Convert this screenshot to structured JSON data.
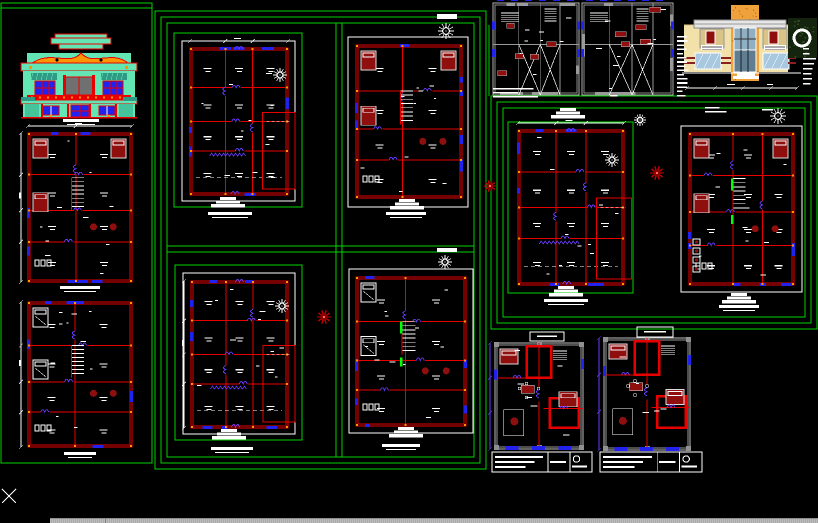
{
  "app": {
    "name": "cad-model-space",
    "background": "#000000",
    "width": 818,
    "height": 523
  },
  "palette": {
    "green": "#00d400",
    "green_bright": "#00ff00",
    "red": "#e80000",
    "dark_red": "#8f0f0f",
    "blue": "#2222ee",
    "violet": "#6a3cff",
    "white": "#ffffff",
    "gray_wall": "#a6a6a6",
    "gray_dark": "#8a8a8a",
    "teal": "#63e6b4",
    "teal_dark": "#2f9a85",
    "teal_dot": "#45c49c",
    "orange": "#ff9500",
    "orange_deep": "#e8862a",
    "cream": "#f2e2aa",
    "cream_dark": "#d9c387",
    "glass": "#8fb0c4",
    "glass_dark": "#5f7e92",
    "stipple": "#efa23c",
    "stipple_dot": "#b96f14",
    "foliage": "#15240f",
    "foliage2": "#2e4a1e",
    "beam": "#e6e6e6"
  },
  "frames": [
    {
      "id": "sheet-frame-left",
      "rects": [
        [
          1,
          3,
          151,
          460
        ]
      ]
    },
    {
      "id": "sheet-frame-middle",
      "rects": [
        [
          155,
          11,
          331,
          458
        ],
        [
          161,
          17,
          319,
          446
        ],
        [
          167,
          23,
          307,
          434
        ]
      ]
    },
    {
      "id": "sheet-frame-right",
      "rects": [
        [
          491,
          96,
          326,
          233
        ],
        [
          497,
          102,
          314,
          221
        ],
        [
          503,
          108,
          302,
          209
        ]
      ]
    }
  ],
  "green_lines": [
    [
      1,
      8,
      152,
      8
    ],
    [
      336,
      23,
      336,
      457
    ],
    [
      342,
      23,
      342,
      457
    ],
    [
      167,
      246,
      474,
      246
    ],
    [
      167,
      252,
      474,
      252
    ],
    [
      489,
      25,
      489,
      96
    ]
  ],
  "panels": [
    {
      "id": "panel-mid-top-left",
      "green": [
        174,
        33,
        128,
        174
      ],
      "white": [
        182,
        41,
        113,
        160
      ]
    },
    {
      "id": "panel-mid-top-right",
      "white": [
        348,
        37,
        120,
        170
      ]
    },
    {
      "id": "panel-mid-bottom-left",
      "green": [
        175,
        265,
        127,
        175
      ],
      "white": [
        183,
        273,
        112,
        161
      ]
    },
    {
      "id": "panel-mid-bottom-right",
      "white": [
        349,
        269,
        124,
        164
      ]
    },
    {
      "id": "panel-right-mid",
      "green": [
        508,
        122,
        125,
        171
      ]
    },
    {
      "id": "panel-right-ground",
      "white": [
        681,
        126,
        121,
        166
      ]
    }
  ],
  "white_ticks": [
    [
      437,
      14,
      20,
      5
    ],
    [
      437,
      248,
      20,
      4
    ]
  ],
  "plans": [
    {
      "id": "left-upper",
      "x": 28,
      "y": 133,
      "w": 104,
      "h": 149,
      "seed": 11,
      "furnished": true,
      "beds": "dark",
      "stairs": true,
      "dims": [
        "left",
        "top"
      ],
      "cols": [
        0.46
      ],
      "rows": [
        0.28,
        0.52,
        0.73
      ]
    },
    {
      "id": "left-lower",
      "x": 28,
      "y": 302,
      "w": 104,
      "h": 145,
      "seed": 22,
      "furnished": true,
      "beds": "white",
      "stairs": true,
      "dims": [
        "left"
      ],
      "cols": [
        0.45
      ],
      "rows": [
        0.3,
        0.55,
        0.76
      ]
    },
    {
      "id": "mid-top-left",
      "x": 190,
      "y": 48,
      "w": 98,
      "h": 147,
      "seed": 33,
      "annex": true,
      "zigzag": true,
      "dims": [
        "top"
      ],
      "cols": [
        0.36,
        0.64
      ],
      "rows": [
        0.27,
        0.5,
        0.7
      ]
    },
    {
      "id": "mid-top-right",
      "x": 356,
      "y": 45,
      "w": 106,
      "h": 153,
      "seed": 44,
      "furnished": true,
      "beds": "dark",
      "stairs": true,
      "cols": [
        0.44
      ],
      "rows": [
        0.3,
        0.55,
        0.75
      ]
    },
    {
      "id": "mid-bottom-left",
      "x": 191,
      "y": 281,
      "w": 97,
      "h": 147,
      "seed": 55,
      "annex": true,
      "zigzag": true,
      "dims": [
        "left"
      ],
      "cols": [
        0.36,
        0.64
      ],
      "rows": [
        0.27,
        0.5,
        0.7
      ]
    },
    {
      "id": "mid-bottom-right",
      "x": 356,
      "y": 277,
      "w": 110,
      "h": 149,
      "seed": 66,
      "furnished": true,
      "beds": "white",
      "stairs": true,
      "green_accent": true,
      "cols": [
        0.45
      ],
      "rows": [
        0.3,
        0.56,
        0.76
      ]
    },
    {
      "id": "right-mid-green",
      "x": 518,
      "y": 130,
      "w": 106,
      "h": 155,
      "seed": 99,
      "annex": true,
      "zigzag": true,
      "dims": [
        "top"
      ],
      "cols": [
        0.36,
        0.64
      ],
      "rows": [
        0.27,
        0.5,
        0.7
      ]
    },
    {
      "id": "right-ground",
      "x": 689,
      "y": 133,
      "w": 105,
      "h": 152,
      "seed": 111,
      "furnished": true,
      "beds": "dark",
      "stairs": true,
      "green_accent": true,
      "kitchen": true,
      "cols": [
        0.42,
        0.7
      ],
      "rows": [
        0.28,
        0.52,
        0.74
      ]
    }
  ],
  "gray_plans": [
    {
      "id": "top-strip-left",
      "x": 493,
      "y": 3,
      "w": 86,
      "h": 92,
      "seed": 77
    },
    {
      "id": "top-strip-right",
      "x": 582,
      "y": 3,
      "w": 91,
      "h": 92,
      "seed": 88
    }
  ],
  "apartments": [
    {
      "id": "bottom-right-1",
      "x": 495,
      "y": 343,
      "w": 88,
      "h": 106,
      "seed": 123
    },
    {
      "id": "bottom-right-2",
      "x": 604,
      "y": 338,
      "w": 86,
      "h": 112,
      "seed": 134
    }
  ],
  "elevations": {
    "classic": {
      "id": "house-front-elevation",
      "x": 19,
      "y": 33,
      "w": 120,
      "h": 85
    },
    "modern": {
      "id": "modern-house-elevation",
      "x": 677,
      "y": 2,
      "w": 141,
      "h": 96
    }
  },
  "compasses": [
    [
      446,
      31,
      8
    ],
    [
      280,
      75,
      7
    ],
    [
      282,
      306,
      7
    ],
    [
      445,
      262,
      7
    ],
    [
      612,
      160,
      7
    ],
    [
      640,
      120,
      6
    ],
    [
      778,
      116,
      8
    ]
  ],
  "rosettes": [
    [
      324,
      317,
      7
    ],
    [
      657,
      173,
      7
    ],
    [
      490,
      186,
      6
    ]
  ],
  "porches": [
    [
      228,
      197
    ],
    [
      407,
      199
    ],
    [
      229,
      429
    ],
    [
      406,
      427
    ],
    [
      566,
      286
    ],
    [
      739,
      293
    ],
    [
      568,
      108
    ]
  ],
  "titles": [
    [
      81,
      119,
      36
    ],
    [
      80,
      286,
      40
    ],
    [
      80,
      452,
      32
    ],
    [
      230,
      212,
      44
    ],
    [
      406,
      212,
      40
    ],
    [
      232,
      447,
      42
    ],
    [
      401,
      444,
      38
    ],
    [
      566,
      299,
      44
    ],
    [
      739,
      305,
      40
    ]
  ],
  "label_boxes": [
    [
      530,
      332,
      34,
      9
    ],
    [
      637,
      327,
      36,
      10
    ]
  ],
  "title_blocks": [
    [
      492,
      452,
      100,
      20
    ],
    [
      600,
      452,
      102,
      20
    ]
  ],
  "microtext": [
    {
      "x": 677,
      "y": 36,
      "rows": 15,
      "wmax": 12,
      "gap": 4.2,
      "seed": 5
    },
    {
      "x": 493,
      "y": 88,
      "rows": 3,
      "wmax": 55,
      "gap": 4,
      "seed": 6
    },
    {
      "x": 803,
      "y": 48,
      "rows": 8,
      "wmax": 13,
      "gap": 5,
      "seed": 7
    },
    {
      "x": 705,
      "y": 107,
      "rows": 2,
      "wmax": 27,
      "gap": 4,
      "seed": 8
    },
    {
      "x": 520,
      "y": 96,
      "rows": 1,
      "wmax": 14,
      "gap": 4,
      "seed": 9
    },
    {
      "x": 610,
      "y": 95,
      "rows": 1,
      "wmax": 10,
      "gap": 4,
      "seed": 10
    },
    {
      "x": 762,
      "y": 109,
      "rows": 1,
      "wmax": 18,
      "gap": 4,
      "seed": 12
    }
  ],
  "scrollbar": {
    "x": 50,
    "y": 518,
    "w": 768,
    "h": 5,
    "notch_x": 55
  },
  "cursor": {
    "x": 9,
    "y": 496,
    "size": 7,
    "color": "#ffffff"
  }
}
